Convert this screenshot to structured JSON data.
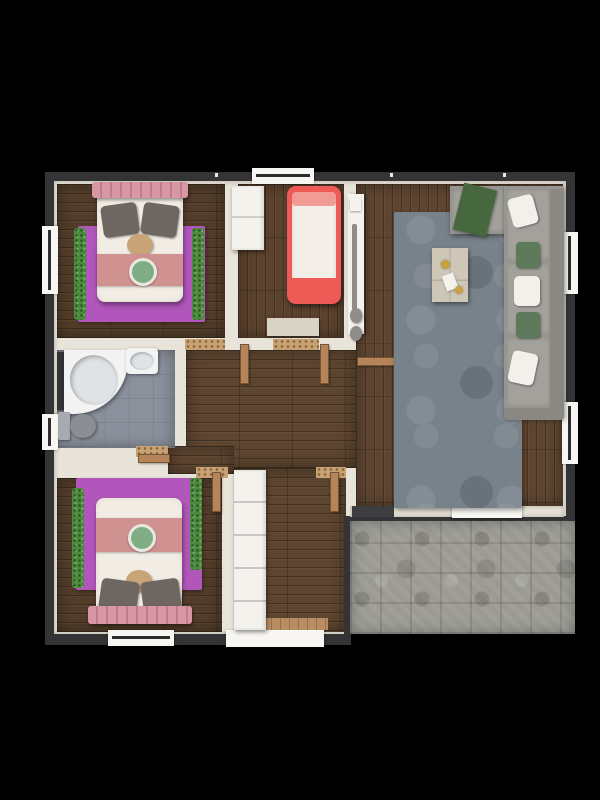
{
  "meta": {
    "description": "3D rendered top-down architectural floor plan of a single-storey home on a black background",
    "view": "top-down orthographic render",
    "visible_text": "none"
  },
  "palette": {
    "bg": "#000000",
    "wall_outer": "#343436",
    "wall_inner": "#e9e4d9",
    "window_white": "#f7f6f2",
    "wood_bedroom": "#533d2a",
    "wood_kids": "#5b422d",
    "wood_living": "#5e4530",
    "wood_hall": "#5d452f",
    "bath_floor": "#8b919c",
    "terrace_stone": "#9b9a93",
    "rug_purple": "#b156ba",
    "rug_gray": "#78828a",
    "garland_green": "#4d8a3f",
    "bed_white": "#f1ede4",
    "pillow_gray": "#6e6761",
    "runner_pink": "#cf9290",
    "ruffle_pink": "#d897a3",
    "cushion_tan": "#c9a476",
    "emblem_green": "#7fae85",
    "red_bed_frame": "#ee5a55",
    "red_bed_accent": "#f29a94",
    "mattress_white": "#f3efe8",
    "mat_beige": "#d9d3c6",
    "sofa_base": "#97958f",
    "sofa_cushion": "#a3a19b",
    "sofa_back": "#8a8883",
    "throw_green": "#47683f",
    "pillow_white": "#f2f0ea",
    "pillow_green": "#5d7a5a",
    "table_beige": "#cec7b8",
    "gold_accent": "#c8a23f",
    "console_white": "#f4f2ec",
    "vase_gray": "#8e8d89",
    "tub_white": "#f2f3f2",
    "tub_inner": "#dfe3e6",
    "toilet_gray": "#8b8e93",
    "threshold_tan": "#c9a273",
    "door_brown": "#b5845a",
    "dark_mat": "#3c3e40",
    "entry_wood": "#b98d62"
  },
  "rooms": [
    {
      "id": "bedroom-top-left",
      "floor": "dark wood planks",
      "contents": [
        "double bed with white duvet",
        "pink ruffled headboard",
        "two gray pillows",
        "tan round cushion",
        "pink bed runner with green emblem",
        "purple area rug",
        "green garland trim",
        "window in left wall"
      ]
    },
    {
      "id": "kids-room-top-middle",
      "floor": "wood planks",
      "contents": [
        "red single bed with white mattress",
        "white wardrobe",
        "beige floor mat",
        "window in top wall"
      ]
    },
    {
      "id": "living-room-right",
      "floor": "wood planks",
      "contents": [
        "gray shag rug",
        "L-shaped gray corner sofa",
        "green throw blanket",
        "white and green pillows",
        "beige coffee table with decor",
        "white wall console with vases",
        "two windows in right wall",
        "sliding door to terrace"
      ]
    },
    {
      "id": "bathroom-mid-left",
      "floor": "gray tile",
      "contents": [
        "corner bathtub",
        "washbasin",
        "toilet",
        "dark vanity strip",
        "window in left wall"
      ]
    },
    {
      "id": "bedroom-bottom-left",
      "floor": "dark wood planks",
      "contents": [
        "double bed with white duvet",
        "pink ruffled footboard",
        "two gray pillows",
        "pink bed runner with green emblem",
        "purple area rug",
        "green garland trim",
        "window in bottom wall"
      ]
    },
    {
      "id": "hallway-and-corridor",
      "floor": "wood planks",
      "contents": [
        "open wooden doors with tan thresholds",
        "tall segmented white wardrobe",
        "entry door in bottom wall with white sill",
        "wooden entry mat"
      ]
    },
    {
      "id": "terrace-bottom-right",
      "floor": "gray stone tiles",
      "contents": [
        "dark door mat",
        "open paved area"
      ]
    }
  ]
}
